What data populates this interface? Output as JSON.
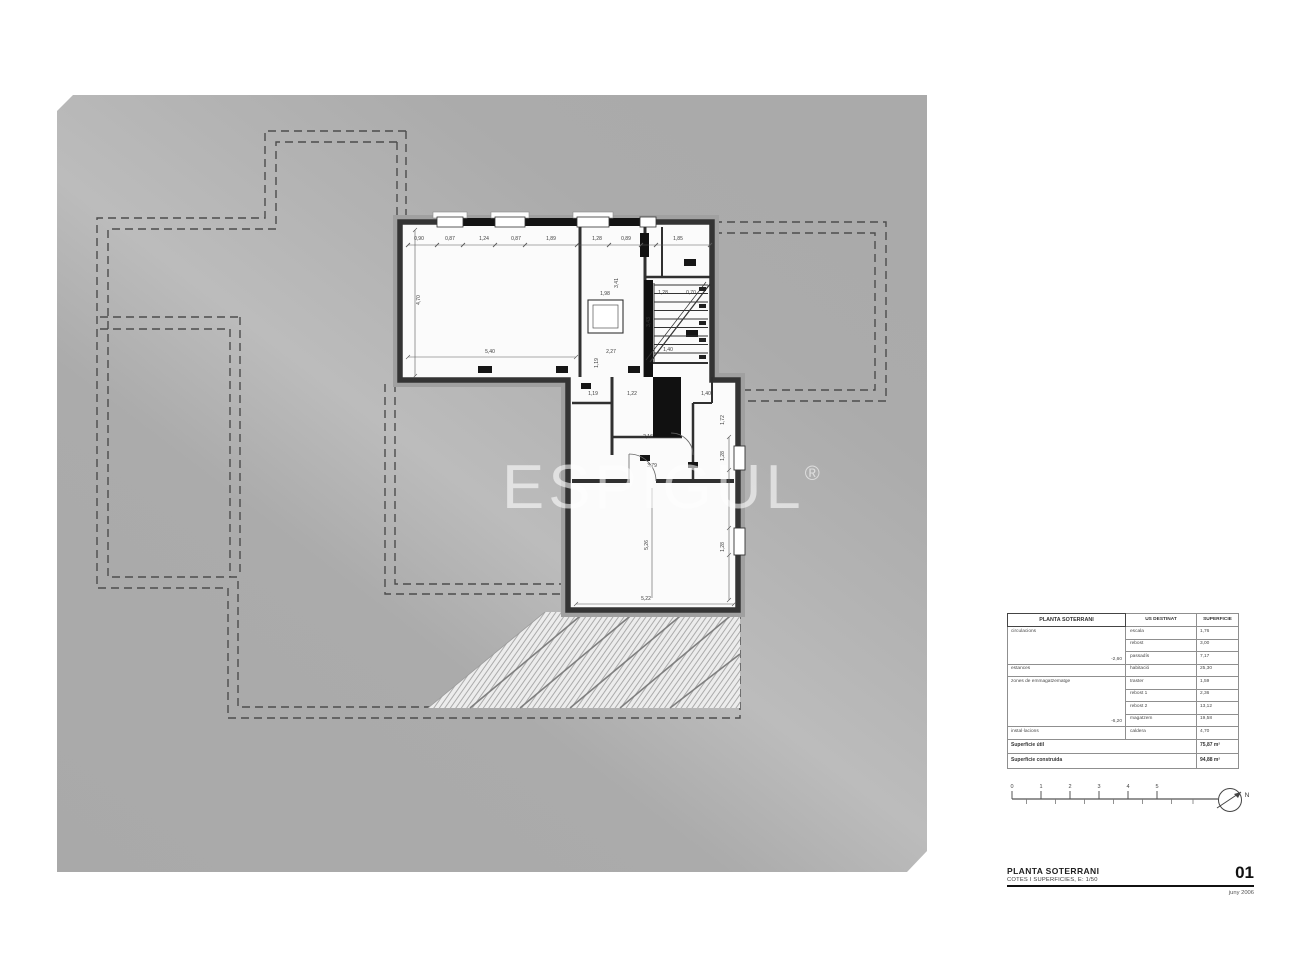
{
  "watermark": {
    "text": "ESPIGUL",
    "reg": "®"
  },
  "table": {
    "headers": [
      "PLANTA SOTERRANI",
      "US DESTINAT",
      "SUPERFICIE"
    ],
    "groups": [
      {
        "zone": "circulacions",
        "note": "-2,60",
        "rows": [
          {
            "use": "escala",
            "area": "1,76"
          },
          {
            "use": "rebost",
            "area": "3,00"
          },
          {
            "use": "passadís",
            "area": "7,17"
          }
        ]
      },
      {
        "zone": "estances",
        "note": "",
        "rows": [
          {
            "use": "habitació",
            "area": "25,30"
          }
        ]
      },
      {
        "zone": "zones de emmagatzematge",
        "note": "-6,20",
        "rows": [
          {
            "use": "traster",
            "area": "1,59"
          },
          {
            "use": "rebost 1",
            "area": "2,36"
          },
          {
            "use": "rebost 2",
            "area": "13,12"
          },
          {
            "use": "magatzem",
            "area": "19,58"
          }
        ]
      },
      {
        "zone": "instal·lacions",
        "note": "",
        "rows": [
          {
            "use": "caldera",
            "area": "4,70"
          }
        ]
      }
    ],
    "totals": [
      {
        "label": "Superficie útil",
        "value": "75,87 m²"
      },
      {
        "label": "Superficie construida",
        "value": "94,88 m²"
      }
    ]
  },
  "titleblock": {
    "title": "PLANTA SOTERRANI",
    "subtitle": "COTES I SUPERFICIES, E: 1/50",
    "sheet_number": "01",
    "date": "juny 2006"
  },
  "scalebar": {
    "ticks": [
      "0",
      "1",
      "2",
      "3",
      "4",
      "5"
    ],
    "north_label": "N"
  },
  "plan": {
    "dim_labels": [
      {
        "t": "0,90",
        "x": 419,
        "y": 240
      },
      {
        "t": "0,87",
        "x": 450,
        "y": 240
      },
      {
        "t": "1,24",
        "x": 484,
        "y": 240
      },
      {
        "t": "0,87",
        "x": 516,
        "y": 240
      },
      {
        "t": "1,89",
        "x": 551,
        "y": 240
      },
      {
        "t": "1,28",
        "x": 597,
        "y": 240
      },
      {
        "t": "0,89",
        "x": 626,
        "y": 240
      },
      {
        "t": "1,85",
        "x": 678,
        "y": 240
      },
      {
        "t": "4,70",
        "x": 420,
        "y": 300,
        "r": -90
      },
      {
        "t": "5,40",
        "x": 490,
        "y": 353
      },
      {
        "t": "1,98",
        "x": 605,
        "y": 295
      },
      {
        "t": "3,41",
        "x": 618,
        "y": 283,
        "r": -90
      },
      {
        "t": "2,27",
        "x": 611,
        "y": 353
      },
      {
        "t": "1,28",
        "x": 663,
        "y": 294
      },
      {
        "t": "0,70",
        "x": 691,
        "y": 294
      },
      {
        "t": "3,43",
        "x": 650,
        "y": 322,
        "r": -90
      },
      {
        "t": "1,40",
        "x": 668,
        "y": 351
      },
      {
        "t": "1,19",
        "x": 598,
        "y": 363,
        "r": -90
      },
      {
        "t": "1,19",
        "x": 593,
        "y": 395
      },
      {
        "t": "1,22",
        "x": 632,
        "y": 395
      },
      {
        "t": "1,40",
        "x": 706,
        "y": 395
      },
      {
        "t": "2,16",
        "x": 648,
        "y": 438
      },
      {
        "t": "3,79",
        "x": 652,
        "y": 467
      },
      {
        "t": "1,72",
        "x": 724,
        "y": 420,
        "r": -90
      },
      {
        "t": "1,28",
        "x": 724,
        "y": 456,
        "r": -90
      },
      {
        "t": "1,28",
        "x": 724,
        "y": 547,
        "r": -90
      },
      {
        "t": "5,26",
        "x": 648,
        "y": 545,
        "r": -90
      },
      {
        "t": "5,22",
        "x": 646,
        "y": 600
      }
    ]
  },
  "colors": {
    "sheet": "#acacac",
    "sheet_light": "#bcbcbc",
    "wall": "#343434",
    "wall_halo": "#a0a0a0",
    "room": "#fbfbfb",
    "dashed": "#4c4c4c",
    "hatch_bg": "#ececec",
    "hatch_line": "#9a9a9a"
  }
}
